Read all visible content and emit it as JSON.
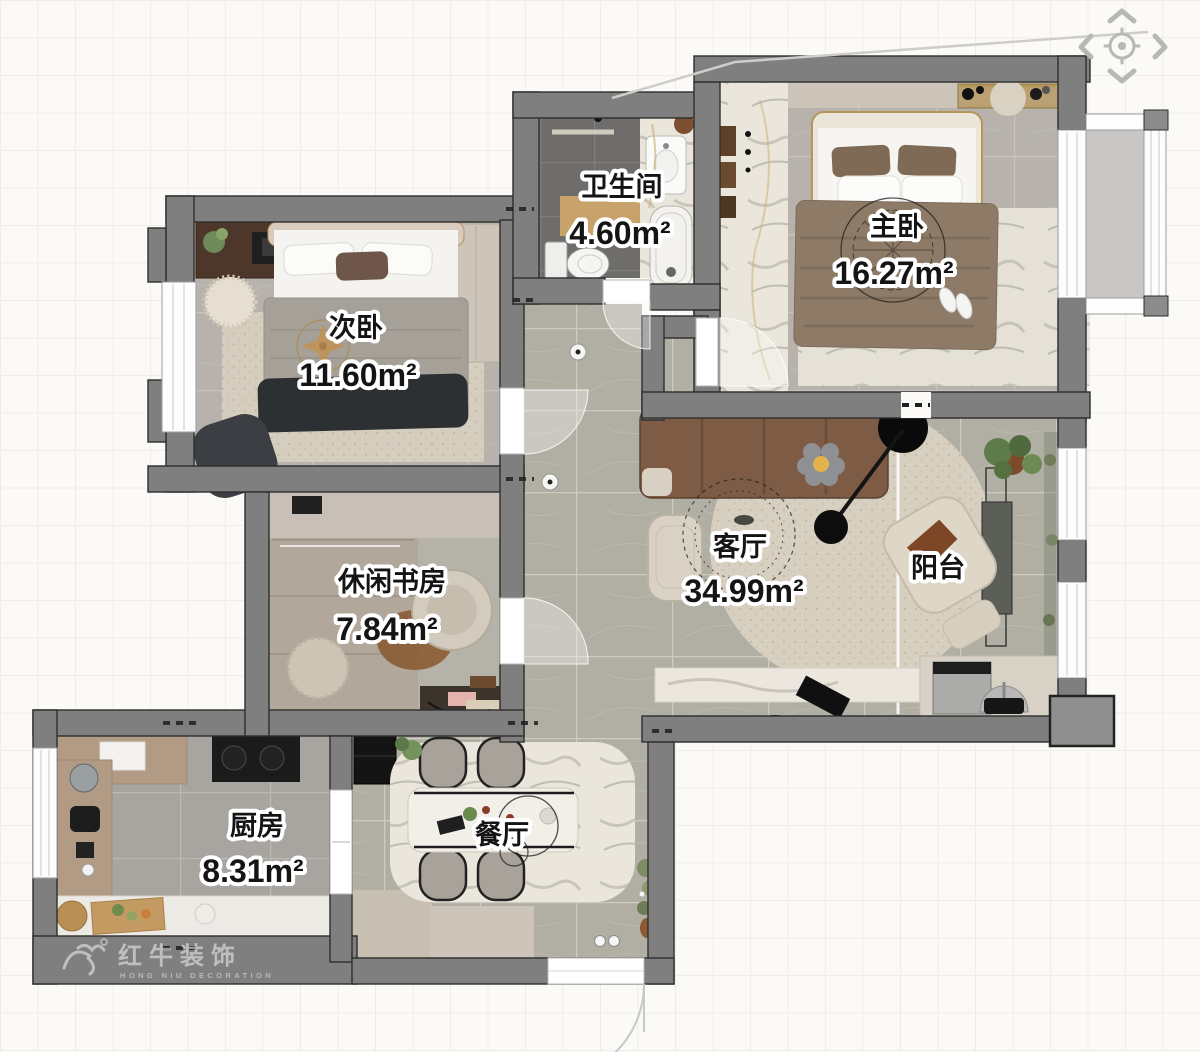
{
  "viewer": {
    "navigation": {
      "up_icon": "chevron-up",
      "down_icon": "chevron-down",
      "left_icon": "chevron-left",
      "right_icon": "chevron-right",
      "recenter_icon": "crosshair-target"
    },
    "watermark": {
      "brand": "红牛装饰",
      "brand_en": "HONG NIU DECORATION"
    }
  },
  "floor_plan": {
    "rooms": [
      {
        "id": "bathroom",
        "name": "卫生间",
        "area": "4.60m²"
      },
      {
        "id": "master-bedroom",
        "name": "主卧",
        "area": "16.27m²"
      },
      {
        "id": "second-bedroom",
        "name": "次卧",
        "area": "11.60m²"
      },
      {
        "id": "study",
        "name": "休闲书房",
        "area": "7.84m²"
      },
      {
        "id": "living-room",
        "name": "客厅",
        "area": "34.99m²"
      },
      {
        "id": "balcony",
        "name": "阳台"
      },
      {
        "id": "kitchen",
        "name": "厨房",
        "area": "8.31m²"
      },
      {
        "id": "dining-room",
        "name": "餐厅"
      }
    ],
    "colors": {
      "wall": "#7f7f7f",
      "wall_outline": "#2d2d2d",
      "label_text": "#141414",
      "label_halo": "#ffffff",
      "floor_tile": "#b7b3ac",
      "floor_marble": "#b1aea3",
      "bathroom_tile": "#6f6d6b",
      "accent_gold": "#b59757",
      "nav_icon": "#b7b7b7"
    }
  }
}
